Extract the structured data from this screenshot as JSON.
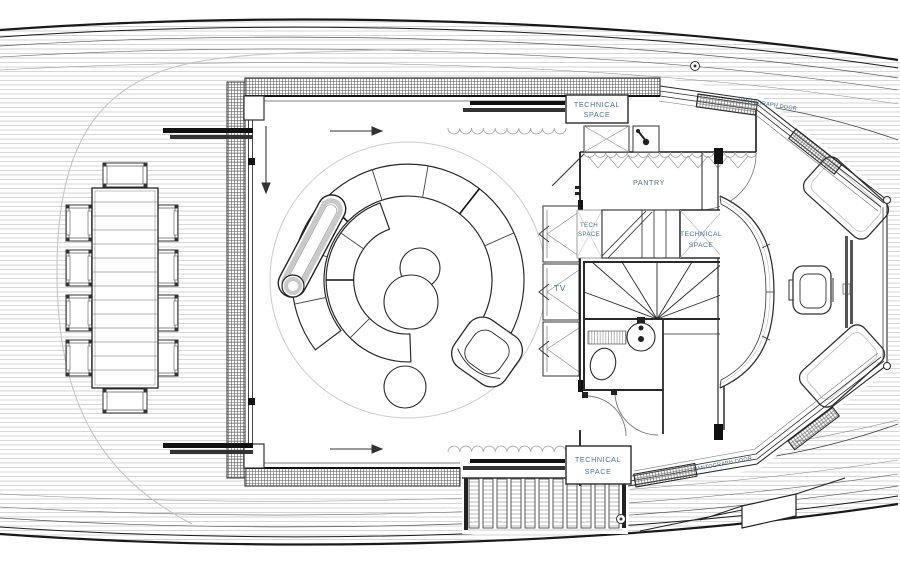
{
  "labels": {
    "technical_space_top": {
      "line1": "TECHNICAL",
      "line2": "SPACE"
    },
    "pantry": "PANTRY",
    "tech_space_small": {
      "line1": "TECH",
      "line2": "SPACE"
    },
    "technical_space_mid": {
      "line1": "TECHNICAL",
      "line2": "SPACE"
    },
    "tv": "TV",
    "technical_space_bottom": {
      "line1": "TECHNICAL",
      "line2": "SPACE"
    },
    "pantograph_door_top": "PANTOGRAPH DOOR",
    "pantograph_door_bottom": "PANTOGRAPH DOOR"
  },
  "colors": {
    "label_text": "#547189",
    "pantograph_label_text": "#44607c",
    "drawing_line": "#2a2a2a",
    "plank_line": "#b4b4b4",
    "accent_dark": "#111111",
    "light_gray": "#c5c5c5"
  }
}
